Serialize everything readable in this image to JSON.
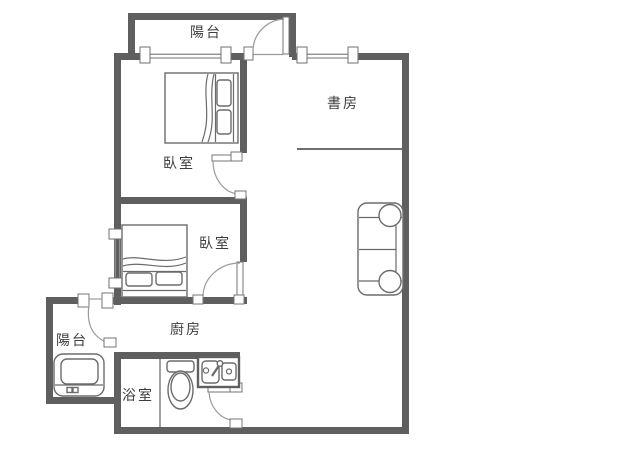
{
  "title": "Apartment floor plan",
  "rooms": [
    {
      "id": "balcony-top",
      "label": "陽台"
    },
    {
      "id": "study",
      "label": "書房"
    },
    {
      "id": "bedroom-a",
      "label": "臥室"
    },
    {
      "id": "bedroom-b",
      "label": "臥室"
    },
    {
      "id": "kitchen",
      "label": "廚房"
    },
    {
      "id": "balcony-bottom",
      "label": "陽台"
    },
    {
      "id": "bathroom",
      "label": "浴室"
    }
  ],
  "fixtures": [
    "double-bed",
    "double-bed",
    "sofa",
    "washing-machine",
    "toilet",
    "sink-counter"
  ],
  "theme": {
    "wall_color": "#5f5f5f",
    "furniture_color": "#6b6b6b",
    "window_color": "#8f8f8f",
    "door_arc_color": "#9a9a9a",
    "text_color": "#3e3e3e",
    "background": "#ffffff"
  }
}
